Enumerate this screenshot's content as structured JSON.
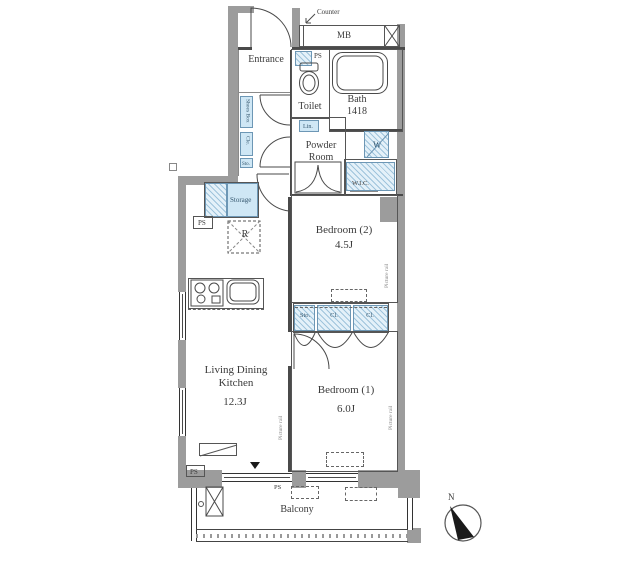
{
  "floor_plan": {
    "rooms": {
      "entrance": "Entrance",
      "toilet": "Toilet",
      "bath": "Bath",
      "bath_size": "1418",
      "powder_line1": "Powder",
      "powder_line2": "Room",
      "bedroom2": "Bedroom (2)",
      "bedroom2_size": "4.5J",
      "bedroom1": "Bedroom (1)",
      "bedroom1_size": "6.0J",
      "ldk_line1": "Living Dining",
      "ldk_line2": "Kitchen",
      "ldk_size": "12.3J",
      "balcony": "Balcony"
    },
    "labels": {
      "counter": "Counter",
      "mb": "MB",
      "ps": "PS",
      "lin": "Lin.",
      "washer": "W",
      "wic": "W.I.C.",
      "shoes_box": "Shoes Box",
      "cle": "Cle.",
      "sto_small": "Sto.",
      "storage": "Storage",
      "refrigerator": "R",
      "closet_sto": "Sto.",
      "closet_cl": "Cl.",
      "picture_rail": "Picture rail",
      "north": "N"
    },
    "colors": {
      "fixture_blue": "#cfe7f5",
      "wall_gray": "#9c9c9c",
      "line": "#4a4a4a",
      "text": "#3a3a3a"
    }
  }
}
